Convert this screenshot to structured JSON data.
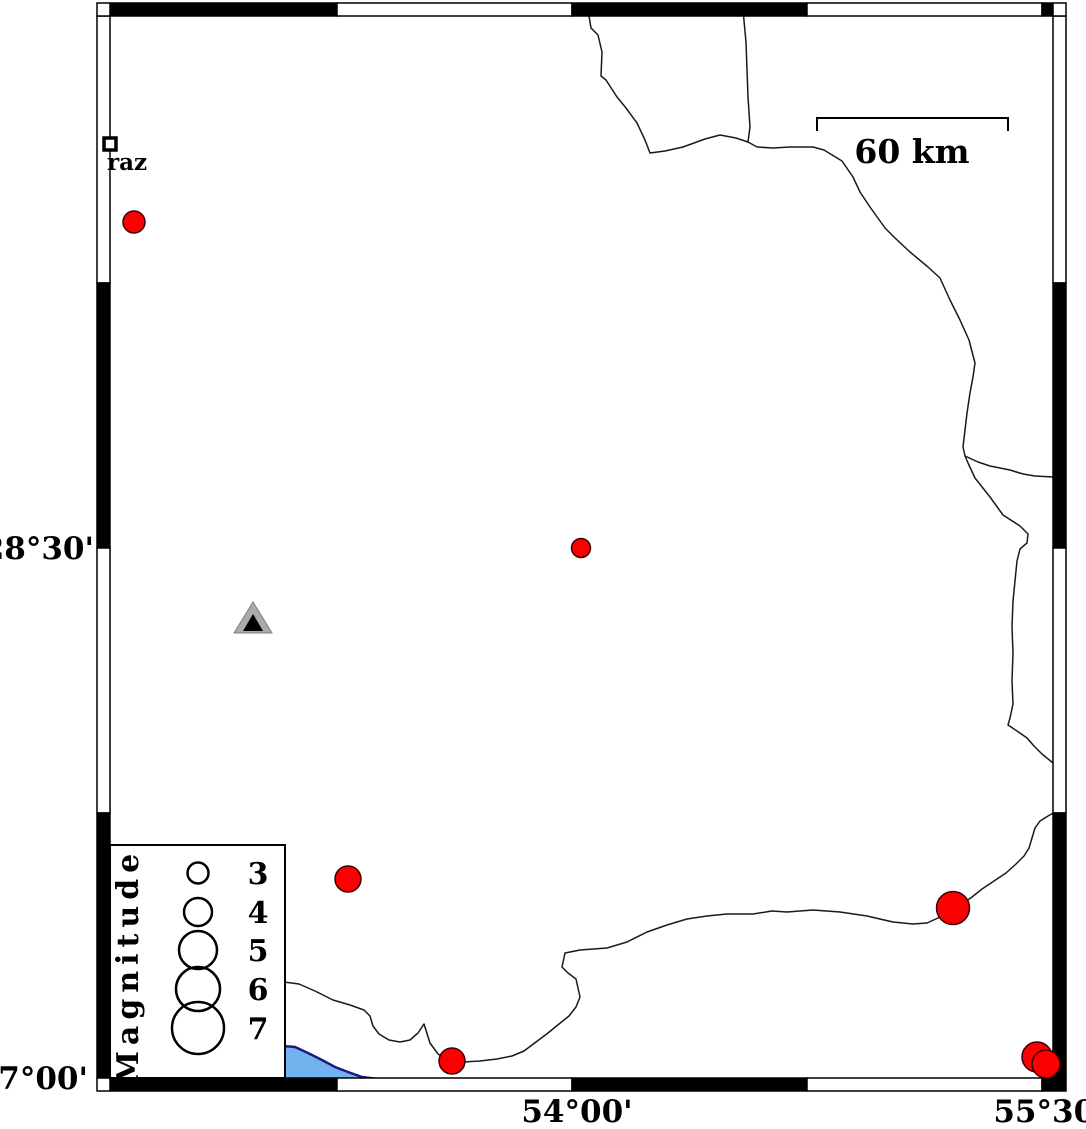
{
  "map": {
    "axis": {
      "left_labels": [
        {
          "text": "28°30'",
          "x": 94,
          "y": 559
        },
        {
          "text": "27°00'",
          "x": 88,
          "y": 1089
        }
      ],
      "bottom_labels": [
        {
          "text": "54°00'",
          "x": 577,
          "y": 1122
        },
        {
          "text": "55°30'",
          "x": 1049,
          "y": 1122
        }
      ]
    },
    "scalebar": {
      "label": "60 km",
      "x1": 817,
      "x2": 1008,
      "y": 118,
      "tick_drop": 13,
      "label_x": 912,
      "label_y": 163
    },
    "city": {
      "label": "raz",
      "marker": {
        "x": 104,
        "y": 138,
        "size": 12
      },
      "label_x": 107,
      "label_y": 170
    },
    "station": {
      "outer": [
        [
          253,
          602
        ],
        [
          234,
          633
        ],
        [
          272,
          633
        ]
      ],
      "inner": [
        [
          253,
          614
        ],
        [
          243,
          631
        ],
        [
          263,
          631
        ]
      ]
    },
    "earthquakes": [
      {
        "x": 134,
        "y": 222,
        "d": 22
      },
      {
        "x": 581,
        "y": 548,
        "d": 19
      },
      {
        "x": 348,
        "y": 879,
        "d": 26
      },
      {
        "x": 953,
        "y": 908,
        "d": 33
      },
      {
        "x": 452,
        "y": 1061,
        "d": 26
      },
      {
        "x": 1037,
        "y": 1057,
        "d": 30
      },
      {
        "x": 1046,
        "y": 1064,
        "d": 28
      }
    ],
    "legend": {
      "title": "Magnitude",
      "box": {
        "x": 110,
        "y": 845,
        "w": 175,
        "h": 233
      },
      "title_cx": 138,
      "title_cy": 966,
      "circle_cx": 198,
      "label_x": 258,
      "entries": [
        {
          "label": "3",
          "d": 21,
          "cy": 873
        },
        {
          "label": "4",
          "d": 28,
          "cy": 912
        },
        {
          "label": "5",
          "d": 38,
          "cy": 950
        },
        {
          "label": "6",
          "d": 44,
          "cy": 989
        },
        {
          "label": "7",
          "d": 52,
          "cy": 1028
        }
      ]
    },
    "frame": {
      "band": 13,
      "left_x": 97,
      "right_x": 1053,
      "top_y": 3,
      "bottom_y": 1078,
      "x_bounds": [
        110,
        337,
        572,
        807,
        1042,
        1053
      ],
      "y_bounds": [
        16,
        283,
        548,
        813,
        1078
      ],
      "x_colors": [
        "#000000",
        "#ffffff",
        "#000000",
        "#ffffff",
        "#000000"
      ],
      "y_colors": [
        "#ffffff",
        "#000000",
        "#ffffff",
        "#000000"
      ],
      "corners": [
        {
          "x": 97,
          "y": 3,
          "fill": "#ffffff"
        },
        {
          "x": 1053,
          "y": 3,
          "fill": "#ffffff"
        },
        {
          "x": 97,
          "y": 1078,
          "fill": "#ffffff"
        },
        {
          "x": 1053,
          "y": 1078,
          "fill": "#000000"
        }
      ]
    },
    "coastlines": [
      [
        [
          588,
          10
        ],
        [
          591,
          28
        ],
        [
          598,
          35
        ],
        [
          602,
          52
        ],
        [
          601,
          76
        ],
        [
          606,
          80
        ],
        [
          617,
          97
        ],
        [
          626,
          108
        ],
        [
          637,
          123
        ],
        [
          645,
          140
        ],
        [
          650,
          153
        ],
        [
          665,
          151
        ],
        [
          683,
          147
        ],
        [
          705,
          139
        ],
        [
          720,
          135
        ],
        [
          736,
          138
        ],
        [
          748,
          142
        ],
        [
          757,
          147
        ],
        [
          773,
          148
        ],
        [
          790,
          147
        ],
        [
          813,
          147
        ],
        [
          824,
          150
        ],
        [
          842,
          161
        ],
        [
          853,
          177
        ],
        [
          860,
          192
        ],
        [
          870,
          207
        ],
        [
          885,
          228
        ],
        [
          895,
          238
        ],
        [
          910,
          252
        ],
        [
          928,
          267
        ],
        [
          940,
          278
        ],
        [
          950,
          300
        ],
        [
          960,
          320
        ],
        [
          969,
          340
        ],
        [
          975,
          363
        ],
        [
          973,
          377
        ],
        [
          970,
          393
        ],
        [
          967,
          413
        ],
        [
          965,
          430
        ],
        [
          963,
          447
        ],
        [
          965,
          456
        ],
        [
          968,
          463
        ],
        [
          975,
          478
        ],
        [
          990,
          497
        ],
        [
          1003,
          515
        ],
        [
          1020,
          526
        ],
        [
          1028,
          534
        ],
        [
          1027,
          543
        ],
        [
          1020,
          549
        ],
        [
          1017,
          561
        ],
        [
          1015,
          581
        ],
        [
          1013,
          601
        ],
        [
          1012,
          627
        ],
        [
          1013,
          653
        ],
        [
          1012,
          681
        ],
        [
          1013,
          704
        ],
        [
          1010,
          718
        ],
        [
          1008,
          725
        ],
        [
          1017,
          731
        ],
        [
          1027,
          738
        ],
        [
          1034,
          746
        ],
        [
          1042,
          754
        ],
        [
          1053,
          763
        ]
      ],
      [
        [
          743,
          10
        ],
        [
          746,
          42
        ],
        [
          748,
          97
        ],
        [
          750,
          127
        ],
        [
          748,
          142
        ]
      ],
      [
        [
          965,
          456
        ],
        [
          978,
          462
        ],
        [
          990,
          466
        ],
        [
          1010,
          470
        ],
        [
          1023,
          474
        ],
        [
          1035,
          476
        ],
        [
          1053,
          477
        ]
      ],
      [
        [
          1055,
          812
        ],
        [
          1048,
          816
        ],
        [
          1040,
          821
        ],
        [
          1035,
          828
        ],
        [
          1032,
          838
        ],
        [
          1029,
          848
        ],
        [
          1024,
          856
        ],
        [
          1016,
          864
        ],
        [
          1006,
          873
        ],
        [
          994,
          881
        ],
        [
          982,
          889
        ],
        [
          972,
          897
        ],
        [
          962,
          904
        ],
        [
          953,
          908
        ]
      ],
      [
        [
          948,
          911
        ],
        [
          938,
          918
        ],
        [
          927,
          923
        ],
        [
          913,
          924
        ],
        [
          893,
          922
        ],
        [
          867,
          916
        ],
        [
          840,
          912
        ],
        [
          813,
          910
        ],
        [
          787,
          912
        ],
        [
          772,
          911
        ],
        [
          753,
          914
        ],
        [
          727,
          914
        ],
        [
          707,
          916
        ],
        [
          687,
          919
        ],
        [
          667,
          925
        ],
        [
          647,
          932
        ],
        [
          627,
          942
        ],
        [
          607,
          948
        ],
        [
          580,
          950
        ],
        [
          565,
          953
        ],
        [
          562,
          967
        ],
        [
          568,
          973
        ],
        [
          576,
          979
        ],
        [
          578,
          988
        ],
        [
          580,
          997
        ],
        [
          576,
          1007
        ],
        [
          569,
          1016
        ],
        [
          559,
          1024
        ],
        [
          548,
          1033
        ],
        [
          536,
          1042
        ],
        [
          524,
          1051
        ],
        [
          512,
          1056
        ],
        [
          497,
          1059
        ],
        [
          480,
          1061
        ],
        [
          463,
          1062
        ],
        [
          448,
          1060
        ],
        [
          438,
          1054
        ],
        [
          430,
          1043
        ],
        [
          424,
          1024
        ],
        [
          418,
          1033
        ],
        [
          410,
          1040
        ],
        [
          400,
          1042
        ],
        [
          389,
          1040
        ],
        [
          379,
          1034
        ],
        [
          373,
          1026
        ],
        [
          370,
          1016
        ],
        [
          364,
          1010
        ],
        [
          350,
          1005
        ],
        [
          333,
          1000
        ],
        [
          315,
          991
        ],
        [
          299,
          984
        ],
        [
          284,
          982
        ]
      ]
    ],
    "water": {
      "polygon": [
        [
          283,
          1046
        ],
        [
          295,
          1047
        ],
        [
          308,
          1053
        ],
        [
          322,
          1060
        ],
        [
          335,
          1067
        ],
        [
          348,
          1072
        ],
        [
          362,
          1077
        ],
        [
          378,
          1079
        ],
        [
          395,
          1080
        ],
        [
          410,
          1079
        ],
        [
          283,
          1079
        ]
      ],
      "edge": [
        [
          283,
          1046
        ],
        [
          295,
          1047
        ],
        [
          308,
          1053
        ],
        [
          322,
          1060
        ],
        [
          335,
          1067
        ],
        [
          348,
          1072
        ],
        [
          362,
          1077
        ],
        [
          378,
          1079
        ],
        [
          395,
          1080
        ],
        [
          410,
          1079
        ]
      ]
    },
    "colors": {
      "earthquake_fill": "#fb0000",
      "earthquake_stroke": "#3c0000",
      "station_fill": "#ababab",
      "station_stroke": "#7d7d7d",
      "station_inner": "#000000",
      "water_fill": "#72b2ee",
      "water_edge": "#1a1a80",
      "coast": "#1a1a1a",
      "frame_stroke": "#000000"
    }
  }
}
